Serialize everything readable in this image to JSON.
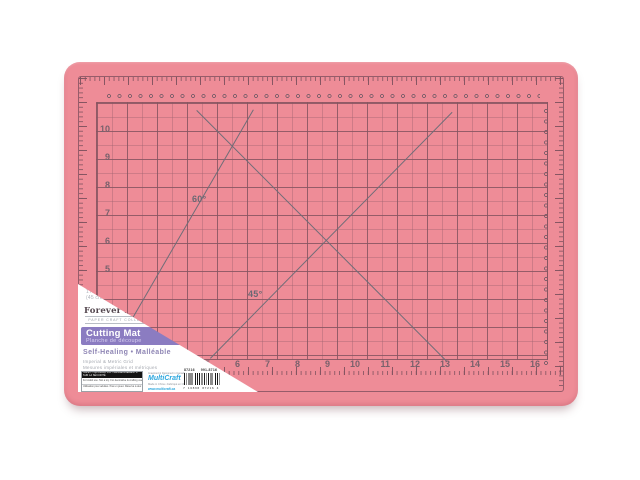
{
  "product": {
    "dimensions_line1": "17.7 in x 12 in",
    "dimensions_line2": "(45 cm x 30 cm)",
    "brand": "Forever in Time",
    "brand_reg": "®",
    "brand_tagline": "PAPER CRAFT COLLECTION",
    "title_en": "Cutting Mat",
    "title_fr": "Planche de découpe",
    "feature_line": "Self-Healing • Malléable",
    "grid_feature_en": "Imperial & Metric Grid",
    "grid_feature_fr": "Mesures impériales et métriques",
    "safety": {
      "header": "SAFETY INFORMATION / RENSEIGNEMENTS SUR LA SÉCURITÉ",
      "row1_en": "For Adult use. Not a toy. For decorative & crafting use only.",
      "row2_fr": "Utilisation pour adultes. Pas un jouet. Réservé à des fins d'artisanat et de décoration."
    },
    "manufacturer": {
      "line1": "Imagined & Designed in Canada",
      "name": "MultiCraft",
      "line2": "Made in China • Fabriqué en Chine",
      "website": "www.multicraft.ca"
    },
    "item_number": "87216",
    "sku": "991-8716",
    "barcode_digits": "7 16898 87216 4"
  },
  "mat": {
    "angle_labels": [
      "60°",
      "45°"
    ],
    "left_scale": [
      "10",
      "9",
      "8",
      "7",
      "6",
      "5"
    ],
    "bottom_scale": [
      "5",
      "6",
      "7",
      "8",
      "9",
      "10",
      "11",
      "12",
      "13",
      "14",
      "15",
      "16"
    ],
    "colors": {
      "mat_pink": "#ee8c97",
      "grid_line": "#865460",
      "angle_line": "#6f6d78",
      "banner_purple": "#8b7cc1",
      "brand_blue": "#2ba7de",
      "label_white": "#ffffff"
    }
  }
}
